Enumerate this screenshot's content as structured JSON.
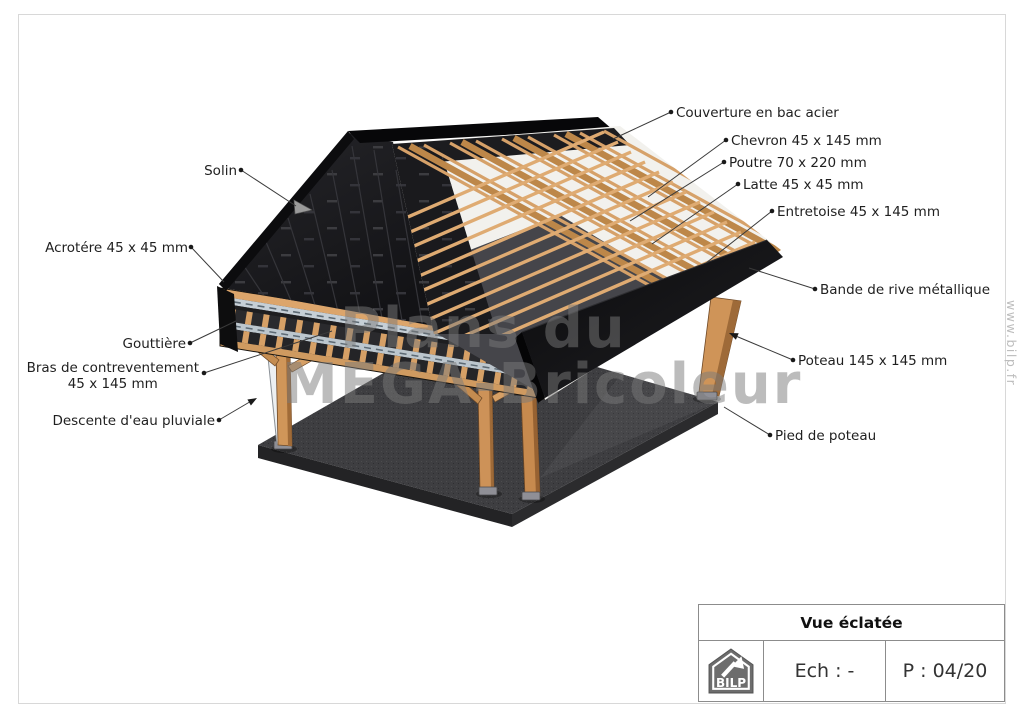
{
  "sheet": {
    "border_color": "#d8d8d8"
  },
  "watermark": {
    "line1": "Plans du",
    "line2": "MEGA-Bricoleur",
    "site_vertical": "www.bilp.fr"
  },
  "callouts": {
    "couverture": {
      "text": "Couverture en bac acier"
    },
    "chevron": {
      "text": "Chevron 45 x 145 mm"
    },
    "poutre": {
      "text": "Poutre 70 x 220 mm"
    },
    "latte": {
      "text": "Latte 45 x 45 mm"
    },
    "entretoise": {
      "text": "Entretoise 45 x 145 mm"
    },
    "bande_rive": {
      "text": "Bande de rive métallique"
    },
    "poteau": {
      "text": "Poteau 145 x 145 mm"
    },
    "pied": {
      "text": "Pied de poteau"
    },
    "solin": {
      "text": "Solin"
    },
    "acrotere": {
      "text": "Acrotére 45 x 45 mm"
    },
    "gouttiere": {
      "text": "Gouttière"
    },
    "bras": {
      "text": "Bras de contreventement\n45 x 145 mm"
    },
    "descente": {
      "text": "Descente d'eau pluviale"
    }
  },
  "title_block": {
    "title": "Vue éclatée",
    "scale_label": "Ech : -",
    "page_label": "P : 04/20",
    "logo_text": "BILP"
  },
  "colors": {
    "wood": "#d29a62",
    "wood_dark": "#a06b38",
    "roof_black": "#1c1c1f",
    "slab_gray": "#3e3e41",
    "gutter_metal": "#c3ccd4",
    "downspout_white": "#eceff1",
    "label_text": "#1f1f1f",
    "block_border": "#8c8c8c",
    "logo_gray": "#6d6d6d",
    "watermark_gray": "#7a7a7a"
  }
}
